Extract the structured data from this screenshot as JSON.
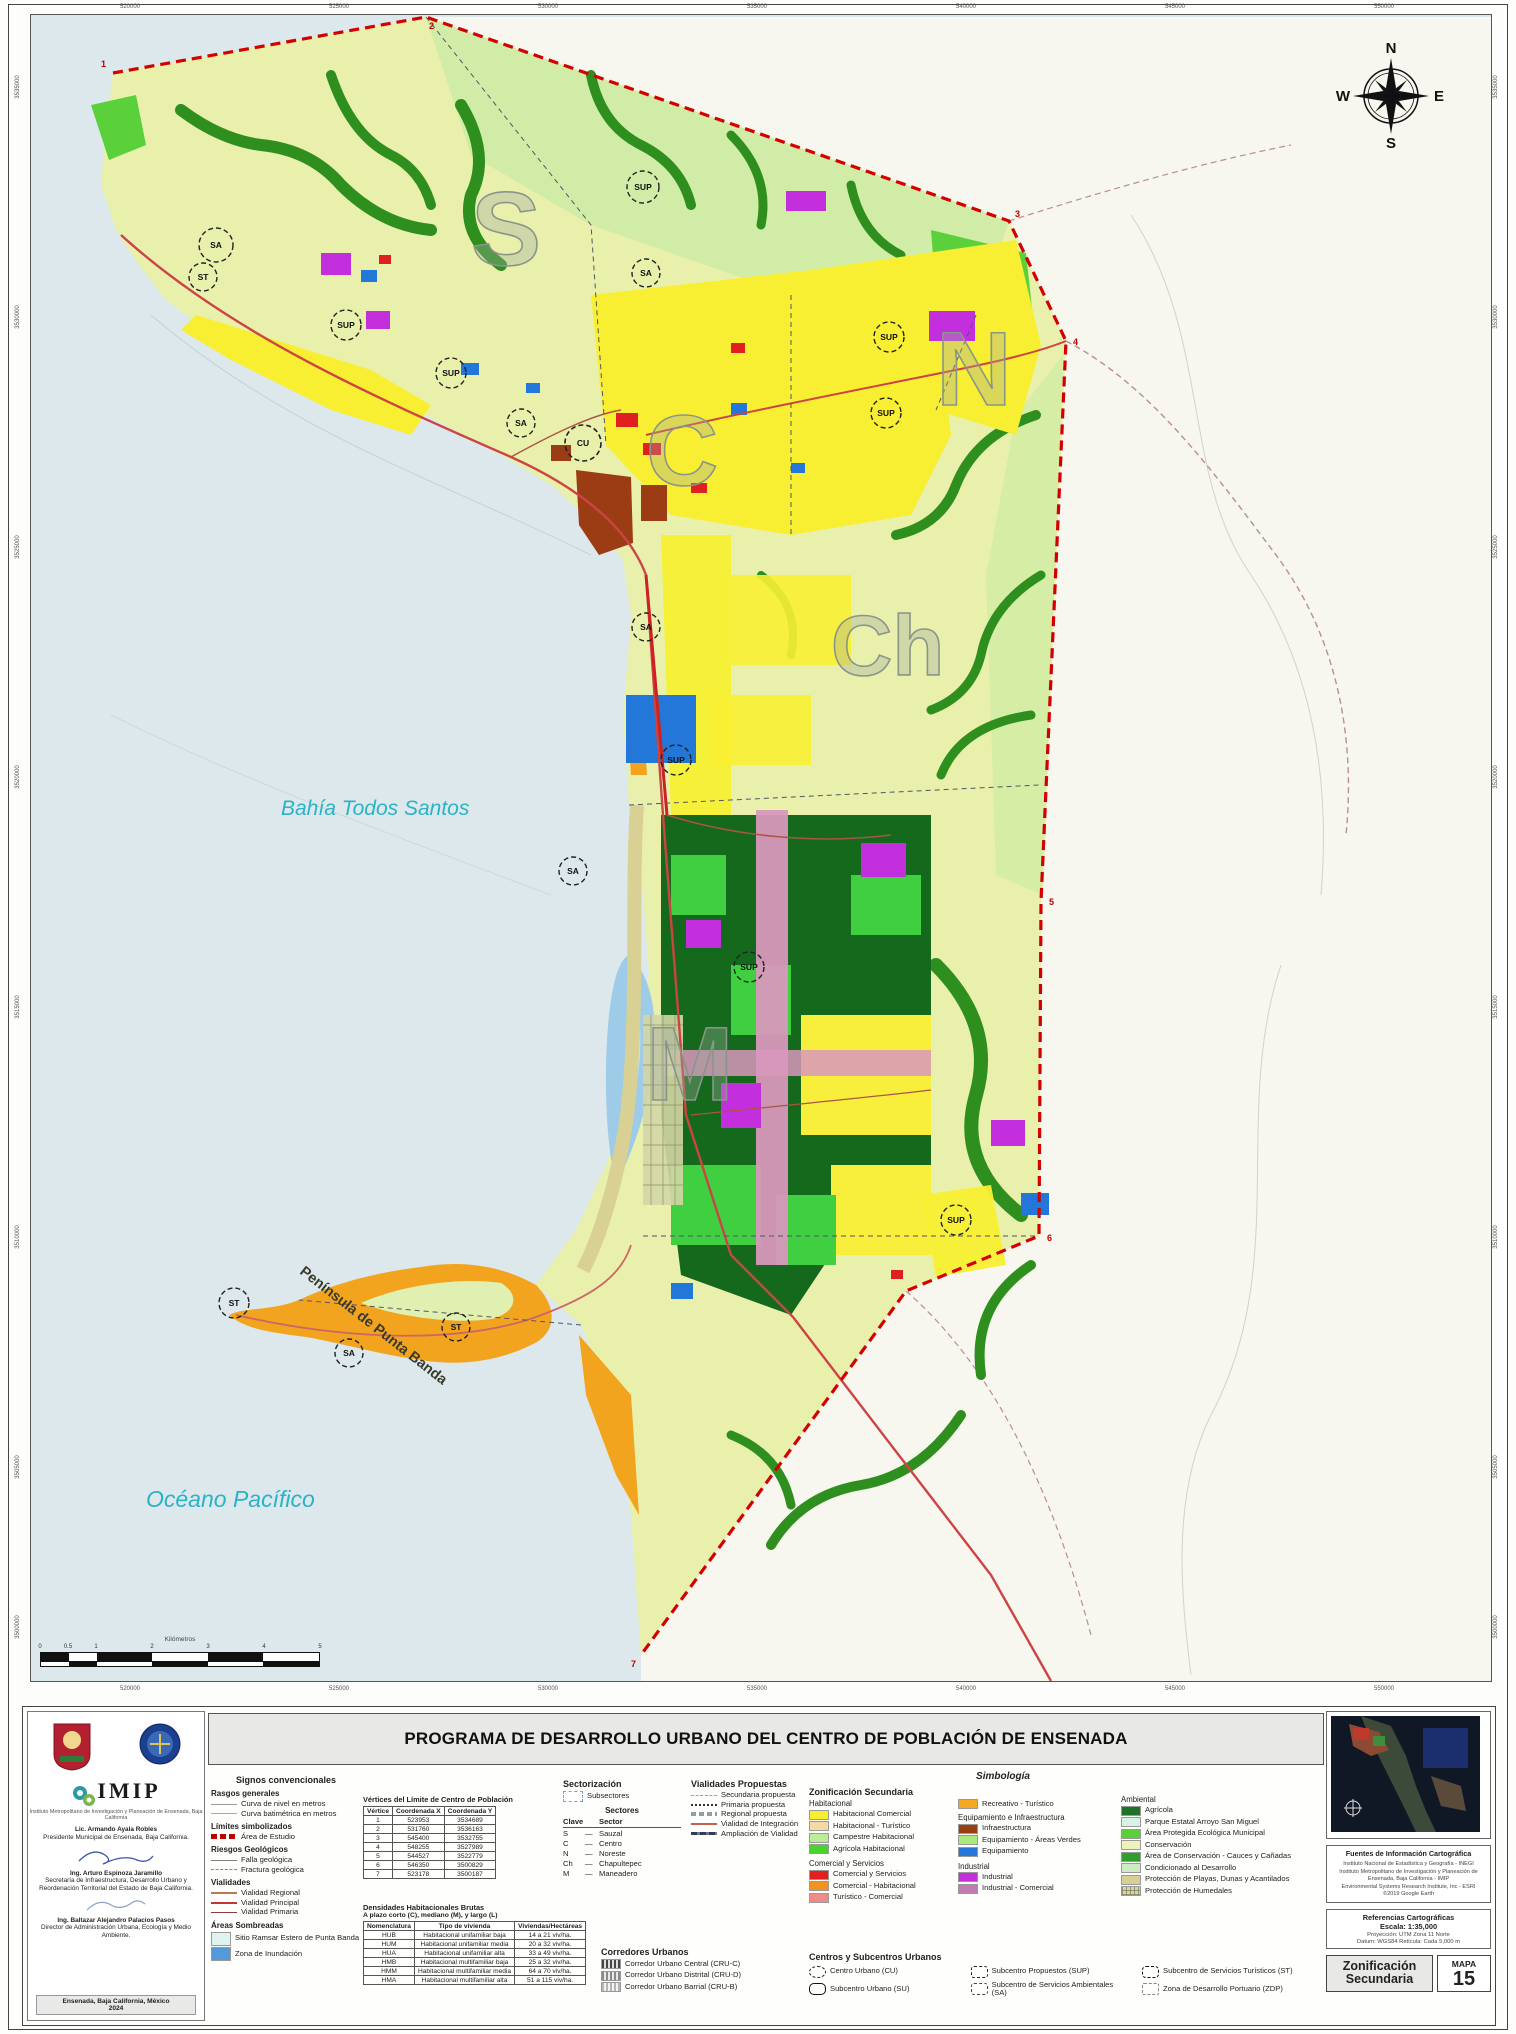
{
  "title": "PROGRAMA DE DESARROLLO URBANO DEL CENTRO DE POBLACIÓN DE ENSENADA",
  "map": {
    "bahia_label": "Bahía Todos Santos",
    "oceano_label": "Océano Pacífico",
    "peninsula_label": "Península de Punta Banda",
    "sector_letters": {
      "s": "S",
      "n": "N",
      "c": "C",
      "ch": "Ch",
      "m": "M"
    },
    "compass": {
      "n": "N",
      "e": "E",
      "s": "S",
      "w": "W"
    },
    "scalebar_title": "Kilómetros",
    "scalebar_ticks": [
      "0",
      "0.5",
      "1",
      "2",
      "3",
      "4",
      "5"
    ],
    "grid_x": [
      "520000",
      "525000",
      "530000",
      "535000",
      "540000",
      "545000",
      "550000"
    ],
    "grid_y": [
      "3535000",
      "3530000",
      "3525000",
      "3520000",
      "3515000",
      "3510000",
      "3505000",
      "3500000"
    ],
    "vertex_labels": [
      "1",
      "2",
      "3",
      "4",
      "5",
      "6",
      "7"
    ],
    "marker_labels": [
      "SA",
      "ST",
      "SUP",
      "SUP",
      "SA",
      "SUP",
      "SA",
      "CU",
      "SUP",
      "SUP",
      "SA",
      "SUP",
      "SA",
      "SUP",
      "ST",
      "SA",
      "ST",
      "SUP"
    ]
  },
  "left_panel": {
    "imip_acronym": "IMIP",
    "imip_sub": "Instituto Metropolitano de Investigación y Planeación de Ensenada, Baja California",
    "officials": [
      {
        "name": "Lic. Armando Ayala Robles",
        "title": "Presidente Municipal de Ensenada, Baja California."
      },
      {
        "name": "Ing. Arturo Espinoza Jaramillo",
        "title": "Secretaría de Infraestructura, Desarrollo Urbano y Reordenación Territorial del Estado de Baja California."
      },
      {
        "name": "Ing. Baltazar Alejandro Palacios Pasos",
        "title": "Director de Administración Urbana, Ecología y Medio Ambiente."
      }
    ],
    "footer": "Ensenada, Baja California, México",
    "year": "2024"
  },
  "legend": {
    "signos": {
      "heading": "Signos convencionales",
      "rasgos_heading": "Rasgos generales",
      "rasgos": [
        "Curva de nivel en metros",
        "Curva batimétrica en metros"
      ],
      "limites_heading": "Límites simbolizados",
      "limites": [
        "Área de Estudio"
      ],
      "riesgos_heading": "Riesgos Geológicos",
      "riesgos": [
        "Falla geológica",
        "Fractura geológica"
      ],
      "vialidades_heading": "Vialidades",
      "vialidades": [
        "Vialidad Regional",
        "Vialidad Principal",
        "Vialidad Primaria"
      ],
      "areas_heading": "Áreas Sombreadas",
      "areas": [
        {
          "label": "Sitio Ramsar Estero de Punta Banda",
          "color": "#dff3f0"
        },
        {
          "label": "Zona de Inundación",
          "color": "#5599dd"
        }
      ]
    },
    "vertices": {
      "title": "Vértices del Límite de Centro de Población",
      "headers": [
        "Vértice",
        "Coordenada X",
        "Coordenada Y"
      ],
      "rows": [
        [
          "1",
          "523953",
          "3534689"
        ],
        [
          "2",
          "531760",
          "3536163"
        ],
        [
          "3",
          "545400",
          "3532755"
        ],
        [
          "4",
          "548255",
          "3527989"
        ],
        [
          "5",
          "544527",
          "3522779"
        ],
        [
          "6",
          "546350",
          "3500829"
        ],
        [
          "7",
          "523178",
          "3500187"
        ]
      ]
    },
    "densidades": {
      "title": "Densidades Habitacionales Brutas",
      "subtitle": "A plazo corto (C), mediano (M), y largo (L)",
      "headers": [
        "Nomenclatura",
        "Tipo de vivienda",
        "Viviendas/Hectáreas"
      ],
      "rows": [
        [
          "HUB",
          "Habitacional unifamiliar baja",
          "14 a 21 viv/ha."
        ],
        [
          "HUM",
          "Habitacional unifamiliar media",
          "20 a 32 viv/ha."
        ],
        [
          "HUA",
          "Habitacional unifamiliar alta",
          "33 a 49 viv/ha."
        ],
        [
          "HMB",
          "Habitacional multifamiliar baja",
          "25 a 32 viv/ha."
        ],
        [
          "HMM",
          "Habitacional multifamiliar media",
          "64 a 70 viv/ha."
        ],
        [
          "HMA",
          "Habitacional multifamiliar alta",
          "51 a 115 viv/ha."
        ]
      ]
    },
    "sectorizacion": {
      "heading": "Sectorización",
      "subsectores": "Subsectores",
      "sectores_heading": "Sectores",
      "clave_header": "Clave",
      "sector_header": "Sector",
      "rows": [
        {
          "clave": "S",
          "sector": "Sauzal"
        },
        {
          "clave": "C",
          "sector": "Centro"
        },
        {
          "clave": "N",
          "sector": "Noreste"
        },
        {
          "clave": "Ch",
          "sector": "Chapultepec"
        },
        {
          "clave": "M",
          "sector": "Maneadero"
        }
      ]
    },
    "vialidades_propuestas": {
      "heading": "Vialidades Propuestas",
      "items": [
        "Secundaria propuesta",
        "Primaria propuesta",
        "Regional propuesta",
        "Vialidad de Integración",
        "Ampliación de Vialidad"
      ]
    },
    "simbologia": {
      "heading": "Simbología",
      "zonificacion_heading": "Zonificación Secundaria",
      "habitacional": {
        "heading": "Habitacional",
        "items": [
          {
            "label": "Habitacional Comercial",
            "color": "#f7ee2f"
          },
          {
            "label": "Habitacional - Turístico",
            "color": "#f3d9a2"
          },
          {
            "label": "Campestre Habitacional",
            "color": "#bdec96"
          },
          {
            "label": "Agrícola Habitacional",
            "color": "#49d331"
          }
        ]
      },
      "comercial": {
        "heading": "Comercial y Servicios",
        "items": [
          {
            "label": "Comercial y Servicios",
            "color": "#e41f1f"
          },
          {
            "label": "Comercial - Habitacional",
            "color": "#f0941f"
          },
          {
            "label": "Turístico - Comercial",
            "color": "#f08c87"
          }
        ]
      },
      "recreativo": {
        "label": "Recreativo - Turístico",
        "color": "#f5a623"
      },
      "equipamiento": {
        "heading": "Equipamiento e Infraestructura",
        "items": [
          {
            "label": "Infraestructura",
            "color": "#993d12"
          },
          {
            "label": "Equipamiento - Áreas Verdes",
            "color": "#abe87e"
          },
          {
            "label": "Equipamiento",
            "color": "#2277d8"
          }
        ]
      },
      "industrial": {
        "heading": "Industrial",
        "items": [
          {
            "label": "Industrial",
            "color": "#c42fdd"
          },
          {
            "label": "Industrial - Comercial",
            "color": "#c27cb4"
          }
        ]
      },
      "ambiental": {
        "heading": "Ambiental",
        "items": [
          {
            "label": "Agrícola",
            "color": "#1d7227"
          },
          {
            "label": "Parque Estatal Arroyo San Miguel",
            "color": "#d9f0e7"
          },
          {
            "label": "Área Protegida Ecológica Municipal",
            "color": "#5ad13a"
          },
          {
            "label": "Conservación",
            "color": "#eef2bc"
          },
          {
            "label": "Área de Conservación - Cauces y Cañadas",
            "color": "#2f9e2f"
          },
          {
            "label": "Condicionado al Desarrollo",
            "color": "#cdecc4"
          },
          {
            "label": "Protección de Playas, Dunas y Acantilados",
            "color": "#d8cf92"
          },
          {
            "label": "Protección de Humedales",
            "color": "#d3d6a6"
          }
        ]
      }
    },
    "centros": {
      "heading": "Centros y Subcentros Urbanos",
      "items": [
        "Centro Urbano (CU)",
        "Subcentro Propuestos (SUP)",
        "Subcentro de Servicios Turísticos (ST)",
        "Subcentro Urbano (SU)",
        "Subcentro de Servicios Ambientales (SA)",
        "Zona de Desarrollo Portuario (ZDP)"
      ]
    },
    "corredores": {
      "heading": "Corredores Urbanos",
      "items": [
        "Corredor Urbano Central (CRU-C)",
        "Corredor Urbano Distrital (CRU-D)",
        "Corredor Urbano Barrial (CRU-B)"
      ]
    }
  },
  "right_panel": {
    "fuentes_heading": "Fuentes de Información Cartográfica",
    "fuentes_lines": [
      "Instituto Nacional de Estadística y Geografía - INEGI",
      "Instituto Metropolitano de Investigación y Planeación de Ensenada, Baja California - IMIP",
      "Environmental Systems Research Institute, Inc - ESRI",
      "©2019 Google Earth"
    ],
    "referencias_heading": "Referencias Cartográficas",
    "escala": "Escala:  1:35,000",
    "proyeccion": "Proyección: UTM Zona 11 Norte",
    "datum": "Datum: WGS84    Retícula: Cada 5,000 m",
    "map_name": "Zonificación Secundaria",
    "mapa_label": "MAPA",
    "mapa_num": "15"
  }
}
